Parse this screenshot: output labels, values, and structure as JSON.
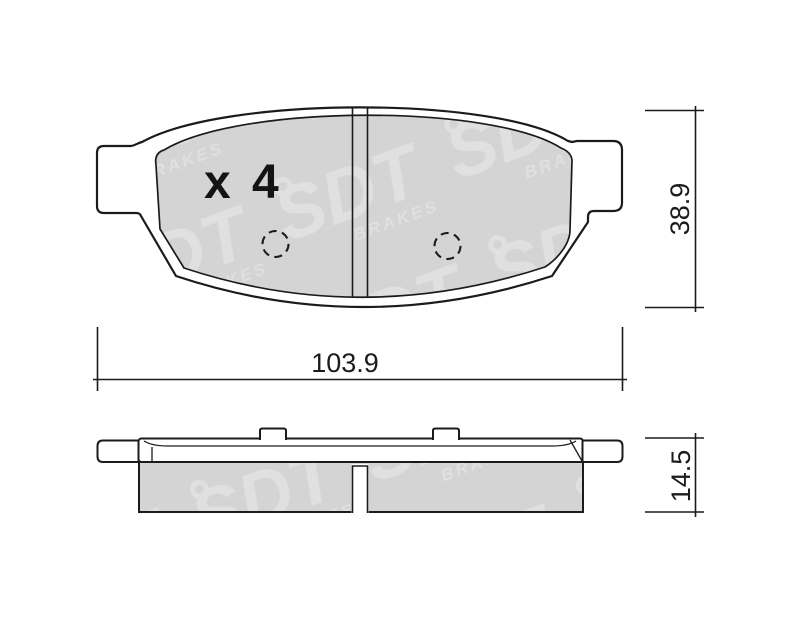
{
  "drawing": {
    "quantity_label": "x 4",
    "watermark": {
      "brand": "SDT",
      "sub": "BRAKES"
    },
    "dimensions": {
      "width_mm": "103.9",
      "height_mm": "38.9",
      "thickness_mm": "14.5"
    },
    "colors": {
      "line": "#1b1b1b",
      "friction_fill": "#d4d4d4",
      "watermark_fill": "#e0e0e0",
      "background": "#ffffff"
    }
  }
}
